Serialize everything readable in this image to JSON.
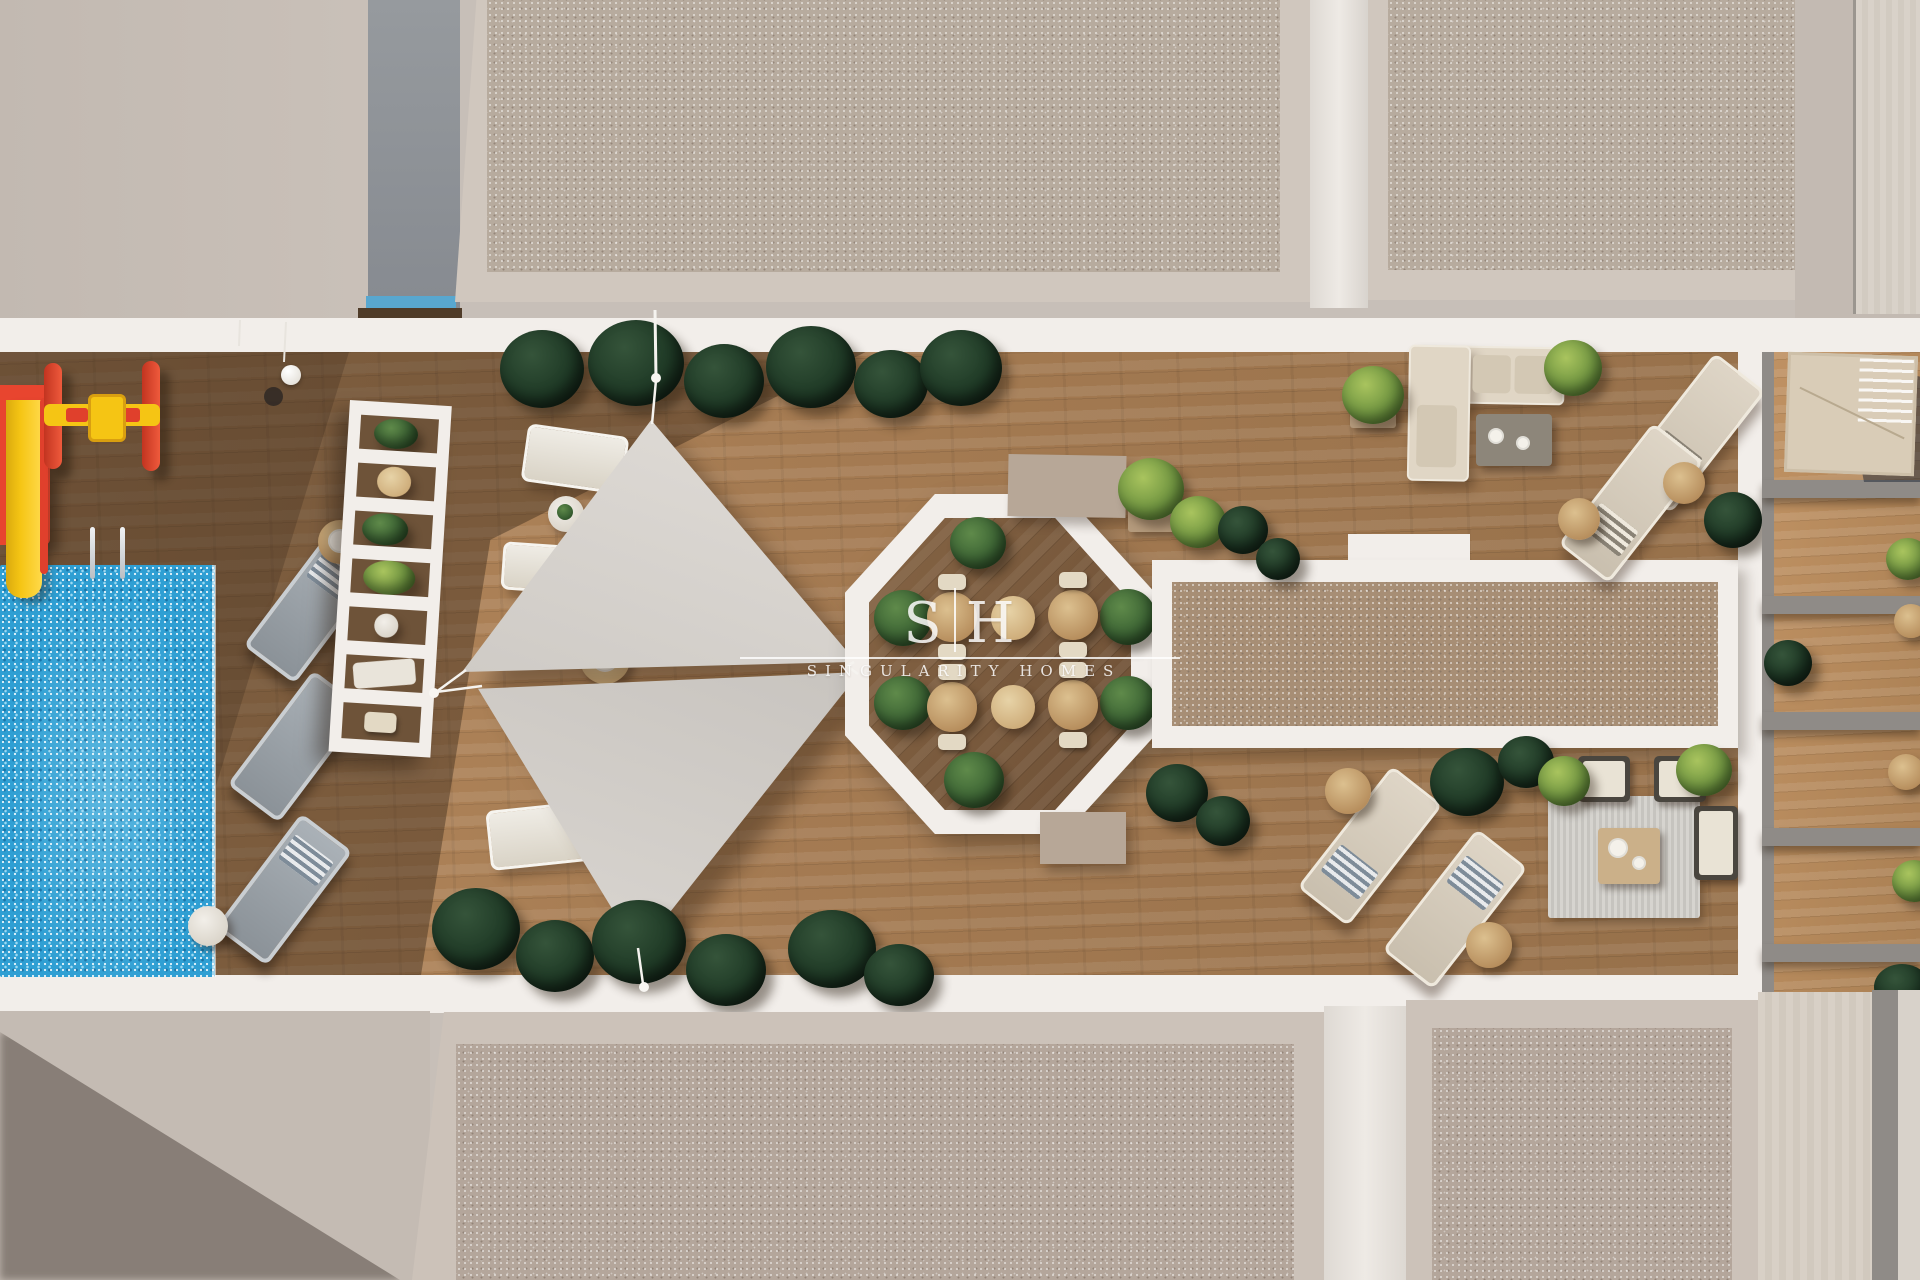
{
  "watermark": {
    "initial_left": "S",
    "initial_right": "H",
    "name": "SINGULARITY HOMES"
  },
  "palette": {
    "ground": "#c7bfb8",
    "ground-light": "#cdc5be",
    "deck-white": "#f2eeea",
    "gravel-top": "#b7ab9e",
    "gravel-pink": "#b4a69b",
    "gravel-brown": "#a78e75",
    "gravel-border": "#d0c7be",
    "wood": "#a87e55",
    "wood-octagon": "#7c5c3d",
    "wood-terrace": "#b58a5d",
    "pool-blue": "#2f9fd3",
    "sail-gray": "#d8d4cf",
    "green-dark": "#1f3a26",
    "green-mid": "#3c6434",
    "green-bright": "#6f9440",
    "slide-red": "#e8452f",
    "slide-yellow": "#f5c514",
    "lounger-gray": "#99a0a6",
    "cream": "#ded5c6",
    "taupe-block": "#b7a797",
    "wall-gray": "#8f8b87",
    "navy-shadow": "#1b2636"
  }
}
